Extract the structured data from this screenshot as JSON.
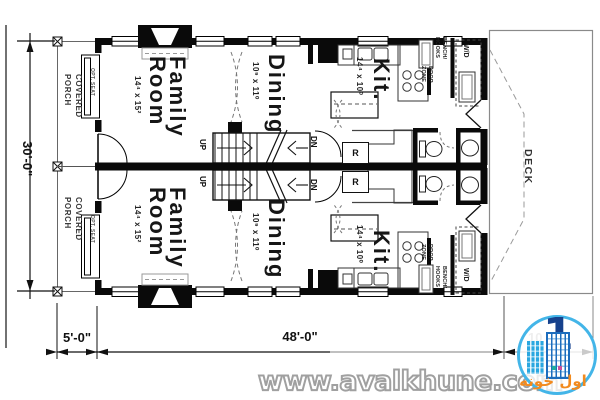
{
  "dims": {
    "total_depth": "30'-0\"",
    "porch_depth": "5'-0\"",
    "house_width": "48'-0\"",
    "deck_dim_partial": "10"
  },
  "deck": {
    "label": "DECK"
  },
  "units": [
    {
      "porch": "COVERED\nPORCH",
      "opt_seat": "OPT. SEAT",
      "family": {
        "name": "Family\nRoom",
        "size": "14⁴ x 15²"
      },
      "dining": {
        "name": "Dining",
        "size": "10⁹ x 11⁰"
      },
      "kitchen": {
        "name": "Kit.",
        "size": "14⁴ x 10⁰"
      },
      "stairs": {
        "up": "UP",
        "down": "DN"
      },
      "fridge": "R",
      "mudroom": {
        "bench": "BENCH/\nHOOKS",
        "drop_zone": "DROP\nZONE",
        "washer_dryer": "W/D"
      }
    },
    {
      "porch": "COVERED\nPORCH",
      "opt_seat": "OPT. SEAT",
      "family": {
        "name": "Family\nRoom",
        "size": "14⁴ x 15²"
      },
      "dining": {
        "name": "Dining",
        "size": "10⁹ x 11⁰"
      },
      "kitchen": {
        "name": "Kit.",
        "size": "14⁴ x 10⁰"
      },
      "stairs": {
        "up": "UP",
        "down": "DN"
      },
      "fridge": "R",
      "mudroom": {
        "bench": "BENCH/\nHOOKS",
        "drop_zone": "DROP\nZONE",
        "washer_dryer": "W/D"
      }
    }
  ],
  "watermark": {
    "url": "www.avalkhune.com"
  },
  "logo": {
    "numeral": "1",
    "brand": "اول خونه",
    "colors": {
      "ring": "#43b5e8",
      "light_blue": "#2aa7e0",
      "dark_blue": "#1c6cbd",
      "navy": "#16418c",
      "orange": "#f28a1e"
    }
  }
}
